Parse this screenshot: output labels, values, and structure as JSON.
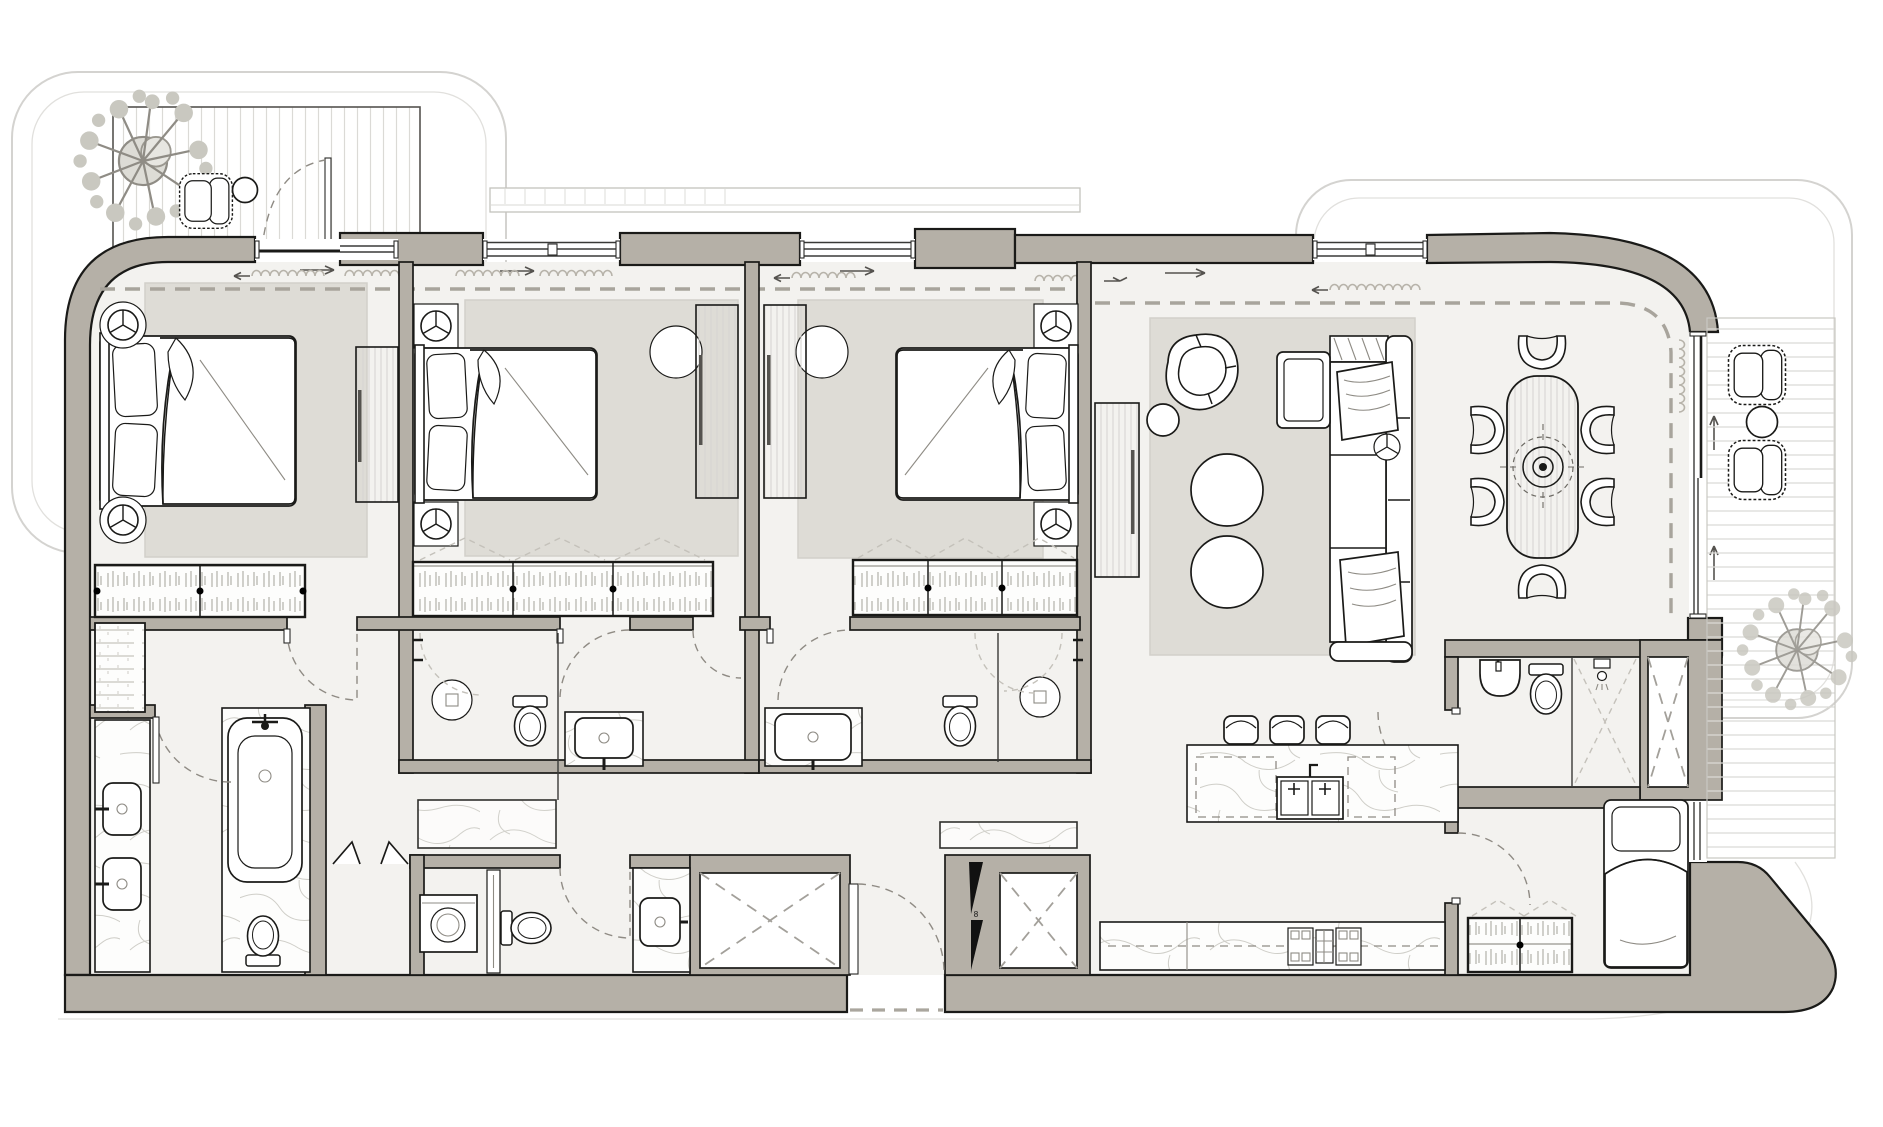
{
  "meta": {
    "title": "Three-bedroom apartment floor plan with two balconies",
    "drawing_type": "architectural furniture layout plan",
    "orientation": "top-down"
  },
  "palette": {
    "wall": "#b5b0a7",
    "line": "#1a1a18",
    "floor": "#f3f2ef",
    "rug": "#dedcd6",
    "dash": "#a8a49c",
    "faint": "#d4d3d0",
    "marble_vein": "#cfcec8",
    "deck_line": "#dbdad6",
    "background": "#ffffff"
  },
  "entry": {
    "riser_label": "8"
  },
  "rooms": [
    {
      "name": "balcony-left",
      "furniture": [
        "tree-planter",
        "lounge-chair",
        "round-side-table",
        "timber-deck",
        "swing-door"
      ]
    },
    {
      "name": "bedroom-1-master",
      "furniture": [
        "double-bed",
        "wall-lamp",
        "wall-lamp",
        "rug",
        "dresser-panel",
        "wardrobe",
        "sliding-balcony-door"
      ]
    },
    {
      "name": "dressing-master",
      "furniture": [
        "linen-closet"
      ]
    },
    {
      "name": "master-bathroom",
      "furniture": [
        "double-vanity",
        "sink",
        "sink",
        "bathtub",
        "toilet"
      ]
    },
    {
      "name": "bedroom-2",
      "furniture": [
        "double-bed",
        "nightstand-lamp",
        "nightstand-lamp",
        "rug",
        "desk-panel",
        "desk-chair",
        "wardrobe",
        "window"
      ]
    },
    {
      "name": "ensuite-2",
      "furniture": [
        "shower",
        "toilet",
        "vanity-sink"
      ]
    },
    {
      "name": "bedroom-3",
      "furniture": [
        "double-bed",
        "nightstand-lamp",
        "nightstand-lamp",
        "rug",
        "desk-panel",
        "desk-chair",
        "wardrobe",
        "window"
      ]
    },
    {
      "name": "ensuite-3",
      "furniture": [
        "vanity-sink",
        "toilet",
        "shower"
      ]
    },
    {
      "name": "corridor",
      "furniture": [
        "bifold-doors"
      ]
    },
    {
      "name": "laundry-wc",
      "furniture": [
        "washing-machine",
        "toilet",
        "vanity-sink"
      ]
    },
    {
      "name": "services",
      "furniture": [
        "shaft-left",
        "shaft-right",
        "riser-panel"
      ]
    },
    {
      "name": "entry-vestibule",
      "furniture": [
        "entry-door"
      ]
    },
    {
      "name": "living-dining",
      "furniture": [
        "armchair",
        "round-side-table",
        "coffee-table",
        "coffee-table",
        "l-shaped-sofa",
        "throw-blanket",
        "tv-sideboard",
        "ceiling-light",
        "dining-table",
        "dining-chair",
        "dining-chair",
        "dining-chair",
        "dining-chair",
        "dining-chair",
        "dining-chair",
        "rug",
        "sliding-balcony-door"
      ]
    },
    {
      "name": "kitchen",
      "furniture": [
        "island-counter",
        "double-sink",
        "dishwasher",
        "bar-stool",
        "bar-stool",
        "bar-stool",
        "back-counter",
        "cooktop",
        "oven"
      ]
    },
    {
      "name": "powder-room",
      "furniture": [
        "wall-basin",
        "toilet",
        "shower",
        "shaft"
      ]
    },
    {
      "name": "maids-room",
      "furniture": [
        "single-bed",
        "wardrobe"
      ]
    },
    {
      "name": "balcony-right",
      "furniture": [
        "wicker-armchair",
        "wicker-armchair",
        "round-side-table",
        "tree-planter",
        "timber-deck"
      ]
    }
  ],
  "symbols": {
    "lamp": "circle-with-three-spokes",
    "shaft": "rectangle-with-dashed-X",
    "door_swing": "dashed-quarter-arc",
    "curtain": "looped-squiggle-with-arrow",
    "wardrobe_fill": "hanging-clothes-hatch",
    "counter_fill": "marble-veining"
  },
  "counts": {
    "bedrooms": 3,
    "bathrooms": 4,
    "balconies": 2,
    "dining_seats": 6,
    "bar_stools": 3
  }
}
